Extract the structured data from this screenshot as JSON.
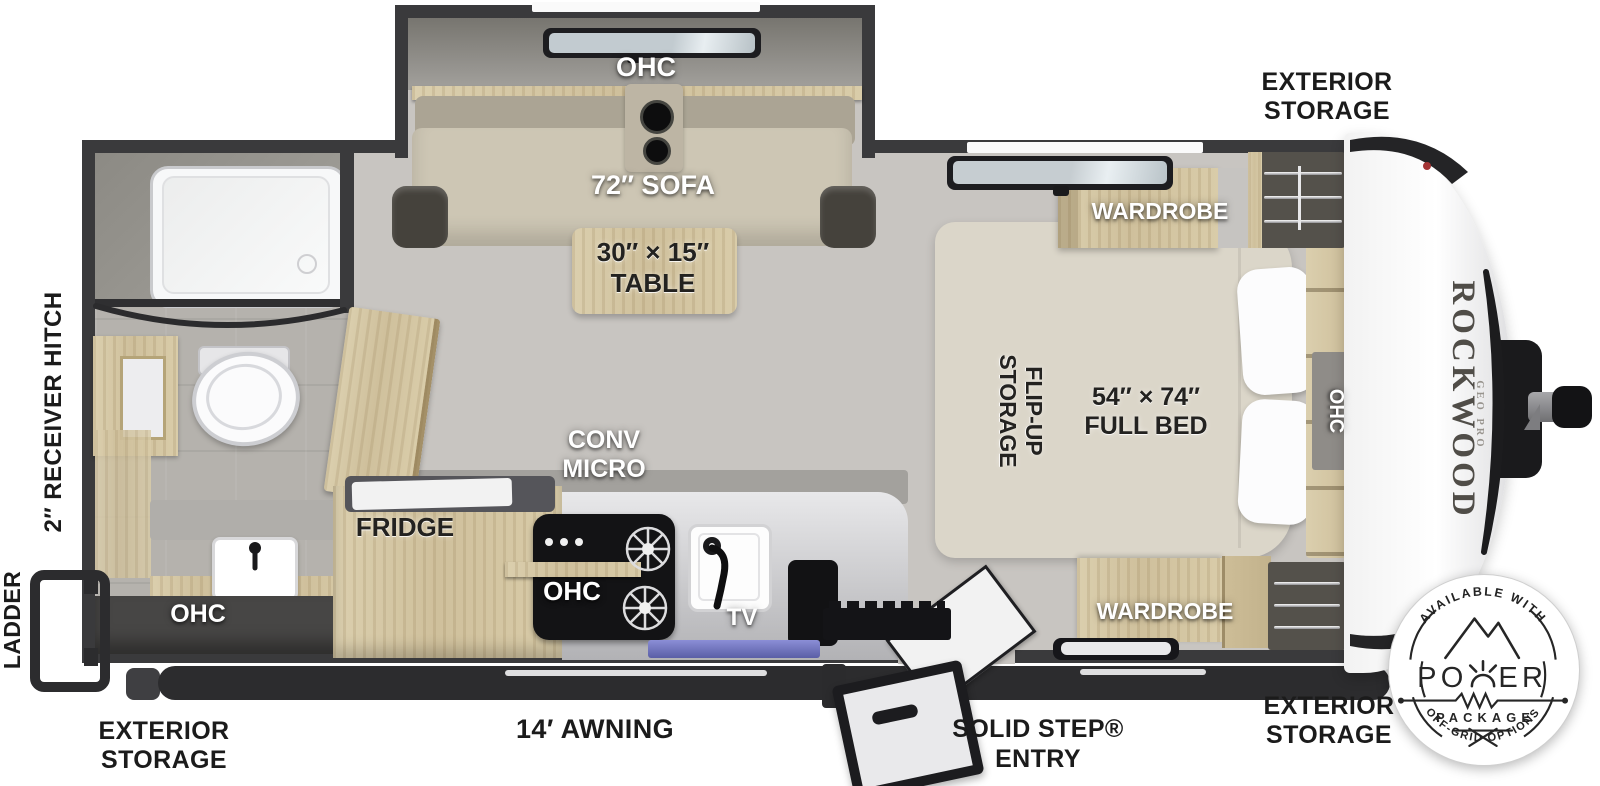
{
  "page": {
    "title": "Rockwood Geo Pro travel trailer floor plan"
  },
  "colors": {
    "wall": "#3a3a3c",
    "floor": "#c8c5c1",
    "wood": "#d5c7a5",
    "sofa": "#cdc6b4",
    "bed": "#dbd6c9",
    "counter": "#d9d9db",
    "stove": "#131315",
    "label_dark": "#232220",
    "label_white": "#ffffff",
    "skirt": "#2c2c2e",
    "tv_strip": "#7b7fc4"
  },
  "exterior": {
    "storage_top_right": {
      "line1": "EXTERIOR",
      "line2": "STORAGE"
    },
    "storage_bottom_right": {
      "line1": "EXTERIOR",
      "line2": "STORAGE"
    },
    "storage_bottom_left": {
      "line1": "EXTERIOR",
      "line2": "STORAGE"
    },
    "awning": "14′ AWNING",
    "solid_step": {
      "line1": "SOLID STEP®",
      "line2": "ENTRY"
    },
    "ladder": "LADDER",
    "receiver_hitch": "2″ RECEIVER HITCH"
  },
  "interior": {
    "dinette": {
      "ohc": "OHC",
      "sofa": "72″ SOFA",
      "table_size": "30″ × 15″",
      "table": "TABLE"
    },
    "bedroom": {
      "wardrobe_top": "WARDROBE",
      "wardrobe_bottom": "WARDROBE",
      "flip_up_line1": "FLIP-UP",
      "flip_up_line2": "STORAGE",
      "bed_size": "54″ × 74″",
      "bed": "FULL BED",
      "ohc": "OHC"
    },
    "bathroom": {
      "ohc": "OHC"
    },
    "kitchen": {
      "fridge": "FRIDGE",
      "conv_line1": "CONV",
      "conv_line2": "MICRO",
      "ohc": "OHC",
      "tv": "TV"
    }
  },
  "branding": {
    "brand": "ROCKWOOD",
    "model": "GEO PRO"
  },
  "badge": {
    "top_arc": "AVAILABLE WITH",
    "power_left": "PO",
    "power_right": "ER",
    "package": "PACKAGE",
    "bottom_arc": "OFF-GRID OPTIONS"
  }
}
